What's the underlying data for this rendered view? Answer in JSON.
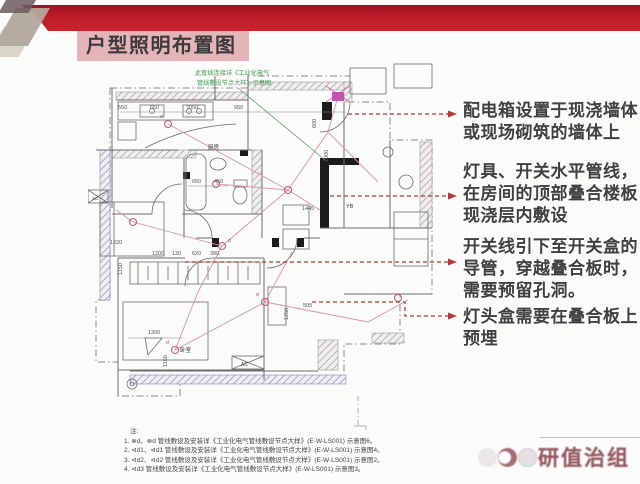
{
  "slide": {
    "title": "户型照明布置图"
  },
  "annotations": [
    {
      "lines": [
        "配电箱设置于现浇墙体",
        "或现场砌筑的墙体上"
      ]
    },
    {
      "lines": [
        "灯具、开关水平管线，",
        "在房间的顶部叠合楼板",
        "现浇层内敷设"
      ]
    },
    {
      "lines": [
        "开关线引下至开关盒的",
        "导管，穿越叠合板时，",
        "需要预留孔洞。"
      ]
    },
    {
      "lines": [
        "灯头盒需要在叠合板上",
        "预埋"
      ]
    }
  ],
  "plan": {
    "green_note": {
      "line1": "此管线连接详《工业化电气",
      "line2": "管线敷设节点大样》示意图"
    },
    "labels": {
      "kitchen": "厨房",
      "bedroom": "卧室",
      "yb": "YB",
      "ac": "AC"
    },
    "lamp_label": "d",
    "dims": {
      "d550": "550",
      "d650": "650",
      "d7050": "7050",
      "d950": "950",
      "d1000": "1000",
      "d600": "600",
      "d1445": "1445",
      "d650b": "650",
      "d450": "450",
      "d1320": "1320",
      "d1200": "1200",
      "d130": "130",
      "d620": "620",
      "d380": "380",
      "d1150": "1150",
      "d1300": "1300",
      "d1150b": "1150",
      "d505": "505",
      "d1250": "1250"
    }
  },
  "notes": {
    "heading": "注:",
    "items": [
      "1. ⊗d、⊗d  管线敷设及安装详《工业化电气管线敷设节点大样》(E-W-LS001) 示意图6。",
      "2. ⊲d1、⊲d1 管线敷设及安装详《工业化电气管线敷设节点大样》(E-W-LS001) 示意图4。",
      "3. ⊲d2、⊲d2 管线敷设及安装详《工业化电气管线敷设节点大样》(E-W-LS001) 示意图2。",
      "4. ⊲d3 管线敷设及安装详《工业化电气管线敷设节点大样》(E-W-LS001) 示意图3。"
    ]
  },
  "watermark": {
    "text": "研值治组"
  },
  "colors": {
    "banner_red": "#c8242f",
    "title_bg": "#e3b4b8",
    "leader_red": "#b23b37",
    "wiring_pink": "#dc94a8",
    "note_green": "#3f9b4f",
    "annotation_text": "#413f40"
  }
}
